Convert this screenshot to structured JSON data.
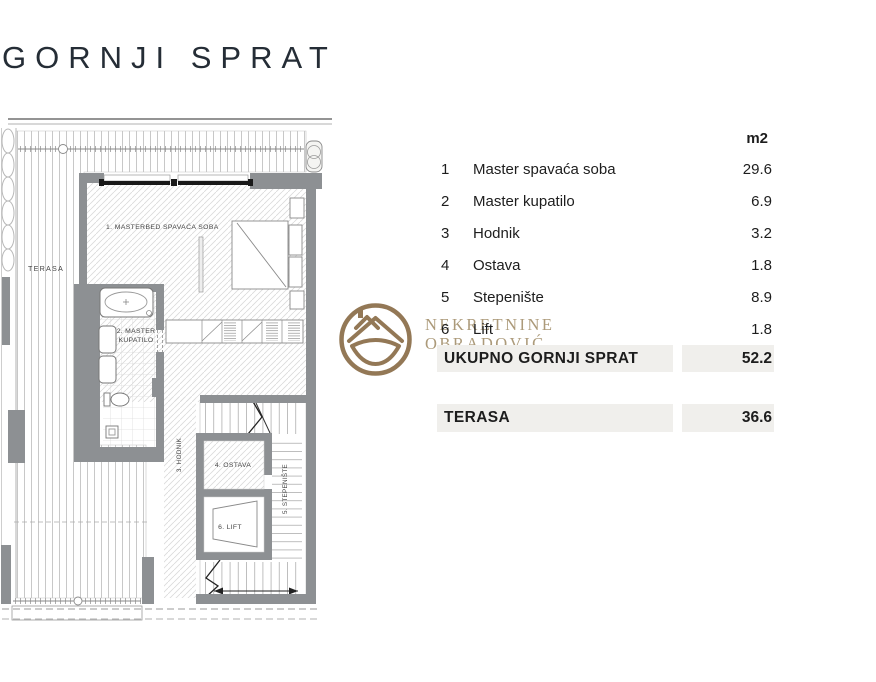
{
  "title": "GORNJI SPRAT",
  "table": {
    "unit_header": "m2",
    "rows": [
      {
        "no": "1",
        "name": "Master spavaća soba",
        "area": "29.6"
      },
      {
        "no": "2",
        "name": "Master kupatilo",
        "area": "6.9"
      },
      {
        "no": "3",
        "name": "Hodnik",
        "area": "3.2"
      },
      {
        "no": "4",
        "name": "Ostava",
        "area": "1.8"
      },
      {
        "no": "5",
        "name": "Stepenište",
        "area": "8.9"
      },
      {
        "no": "6",
        "name": "Lift",
        "area": "1.8"
      }
    ],
    "total": {
      "label": "UKUPNO GORNJI SPRAT",
      "area": "52.2"
    },
    "terrace": {
      "label": "TERASA",
      "area": "36.6"
    }
  },
  "plan": {
    "labels": {
      "terasa": "TERASA",
      "bedroom": "1. MASTERBED SPAVAĆA SOBA",
      "bathroom_line1": "2. MASTER",
      "bathroom_line2": "KUPATILO",
      "hodnik": "3. HODNIK",
      "ostava": "4. OSTAVA",
      "stepeniste": "5. STEPENIŠTE",
      "lift": "6. LIFT"
    }
  },
  "watermark": {
    "line1": "NEKRETNINE",
    "line2": "OBRADOVIĆ"
  },
  "colors": {
    "wall_gray": "#8d9093",
    "row_highlight": "#f0efec",
    "logo_gold": "#8a6d48",
    "logo_text_gold": "#a5926f",
    "title_color": "#252d36",
    "table_text": "#1d1d1d"
  }
}
